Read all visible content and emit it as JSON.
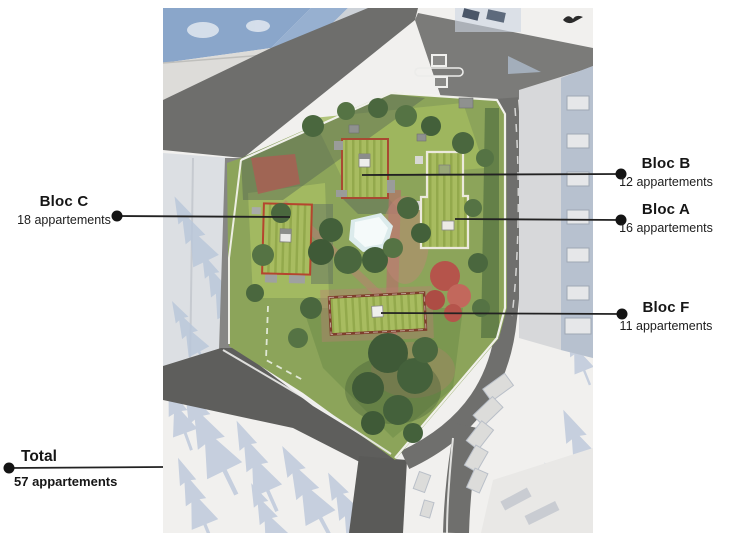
{
  "annotations": {
    "bloc_b": {
      "title": "Bloc B",
      "subtitle": "12 appartements"
    },
    "bloc_a": {
      "title": "Bloc A",
      "subtitle": "16 appartements"
    },
    "bloc_f": {
      "title": "Bloc F",
      "subtitle": "11 appartements"
    },
    "bloc_c": {
      "title": "Bloc C",
      "subtitle": "18 appartements"
    },
    "total": {
      "title": "Total",
      "subtitle": "57 appartements"
    }
  },
  "site_plan": {
    "blocks": [
      {
        "id": "B",
        "apartments": 12
      },
      {
        "id": "A",
        "apartments": 16
      },
      {
        "id": "F",
        "apartments": 11
      },
      {
        "id": "C",
        "apartments": 18
      }
    ],
    "total_apartments": 57,
    "colors": {
      "callout_line": "#222222",
      "roof_green": "#a8bc60",
      "roof_stripe": "#93a94c",
      "bloc_outline_red": "#b5452e",
      "bloc_outline_white": "#ece9dc",
      "site_green": "#8ca45a",
      "road_gray": "#6e6e6c",
      "shadow_blue": "#b6c3d8",
      "blue_roof": "#8aa6ca",
      "pond": "#e9f3f3",
      "red_tree": "#b5544b"
    }
  }
}
